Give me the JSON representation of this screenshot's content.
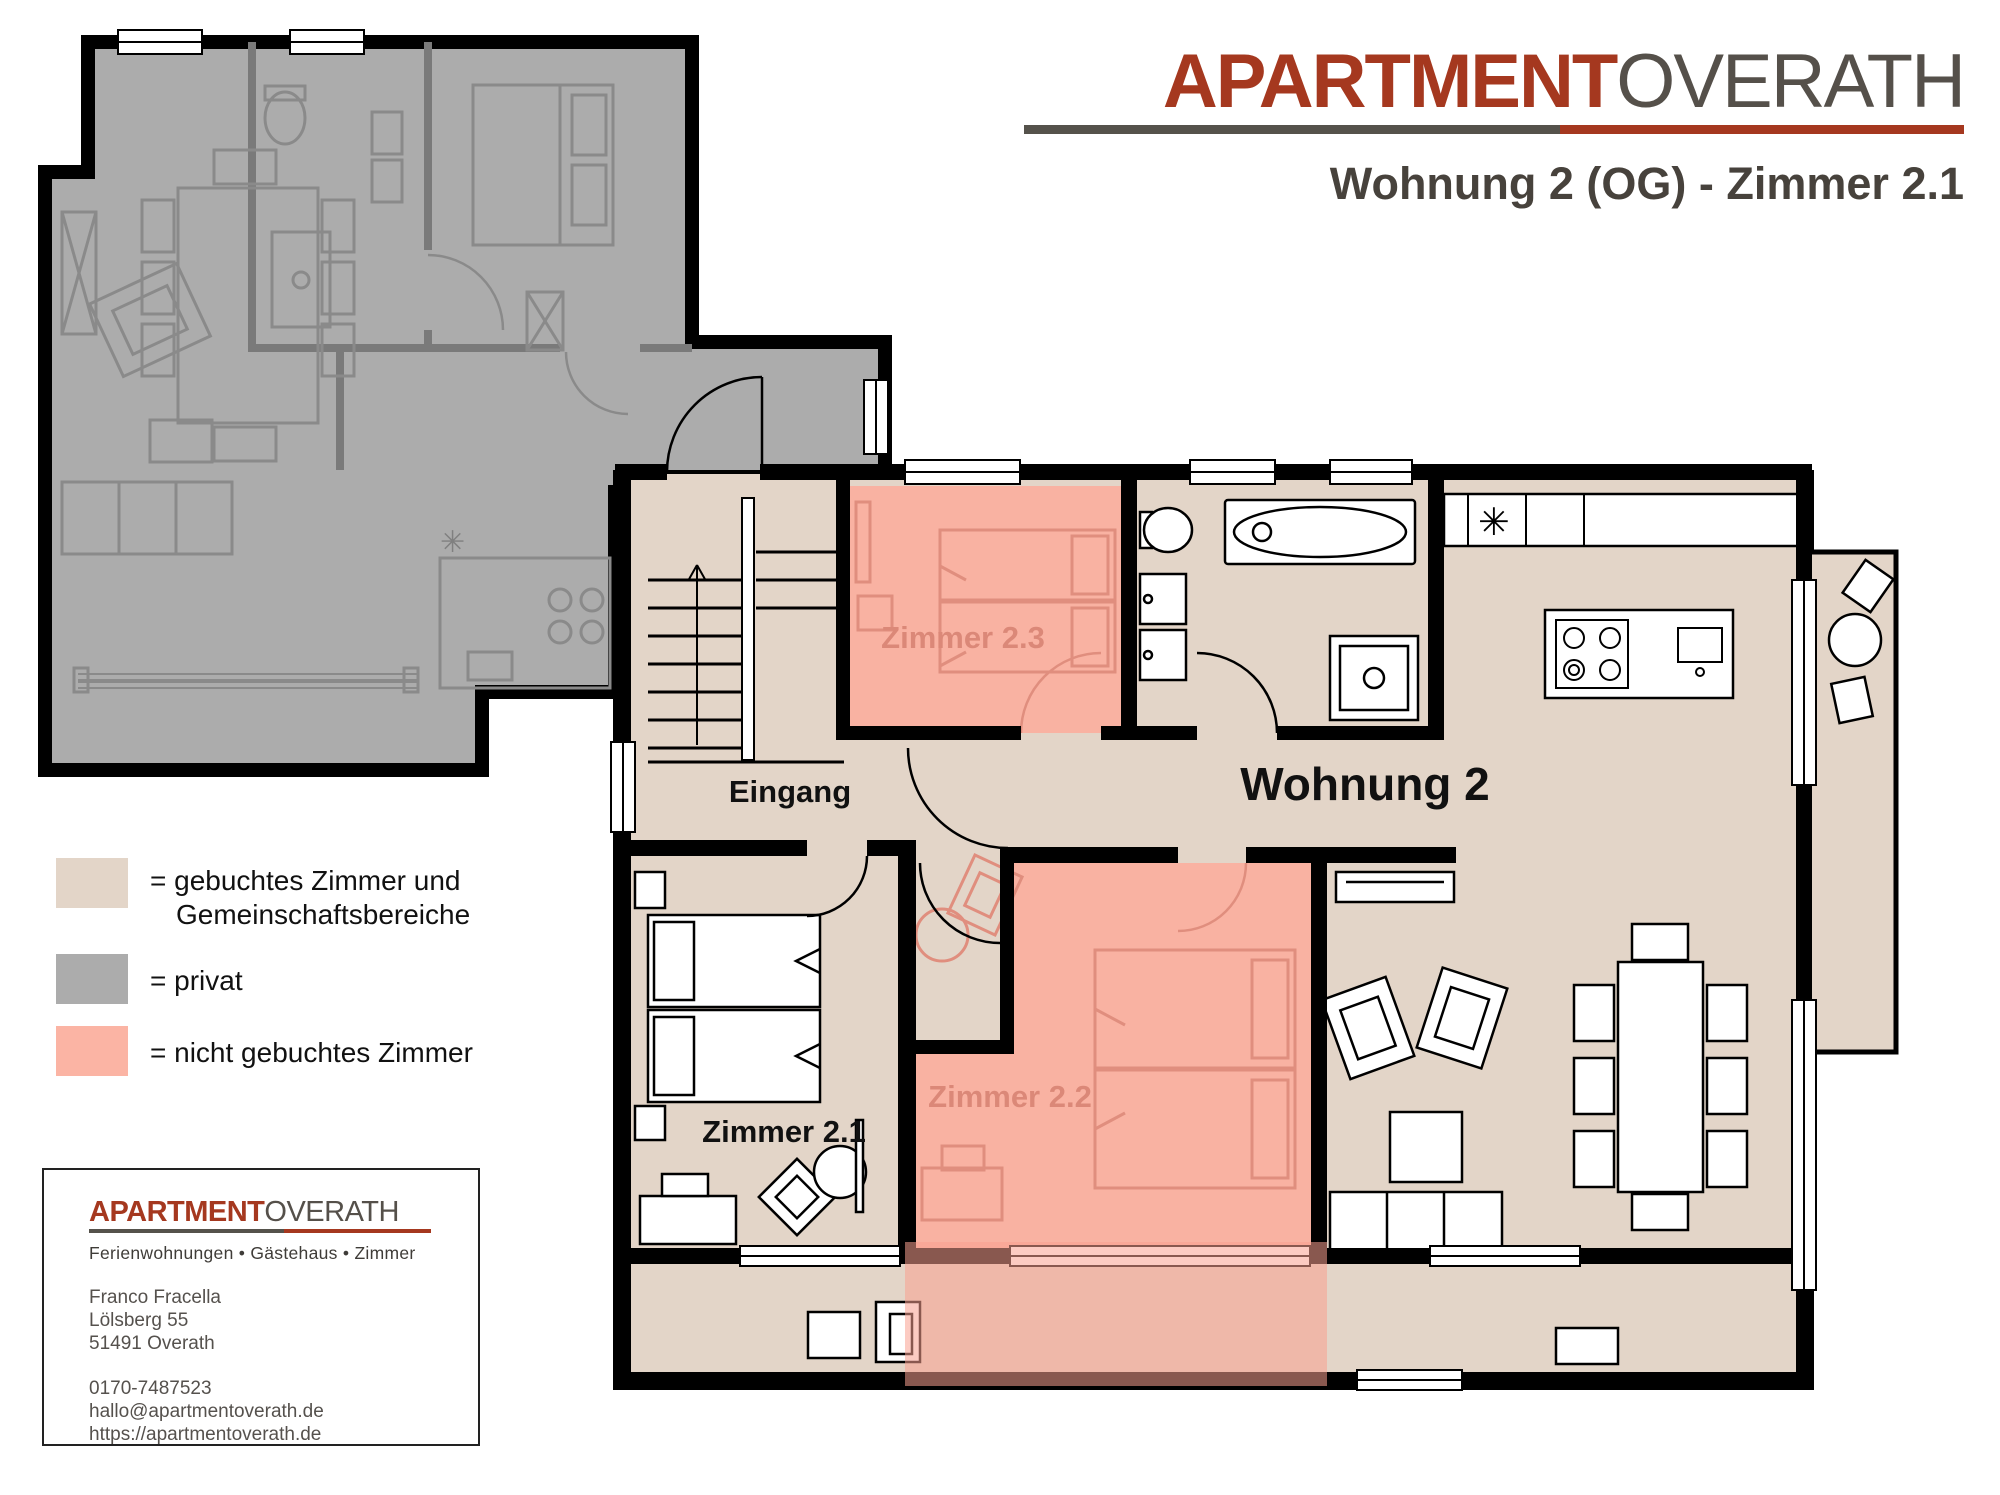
{
  "header": {
    "logo": {
      "part1": "APARTMENT",
      "part2": "OVERATH"
    },
    "subtitle": "Wohnung 2 (OG) - Zimmer 2.1"
  },
  "floorplan": {
    "labels": {
      "eingang": "Eingang",
      "wohnung_2": "Wohnung 2",
      "zimmer_2_1": "Zimmer 2.1",
      "zimmer_2_2": "Zimmer 2.2",
      "zimmer_2_3": "Zimmer 2.3"
    },
    "symbols": {
      "dishwasher_asterisk": "✳"
    },
    "colors": {
      "booked_area": "#E3D5C8",
      "private_area": "#ACACAC",
      "not_booked_room": "#F9B2A2",
      "walls": "#000000",
      "pink_furniture": "#E08E7E"
    }
  },
  "legend": {
    "items": [
      {
        "swatch_color": "#E3D5C8",
        "label": "= gebuchtes Zimmer und",
        "label_line2": "Gemeinschaftsbereiche"
      },
      {
        "swatch_color": "#ACACAC",
        "label": "= privat",
        "label_line2": ""
      },
      {
        "swatch_color": "#FBB4A4",
        "label": "= nicht gebuchtes Zimmer",
        "label_line2": ""
      }
    ]
  },
  "contact_card": {
    "logo": {
      "part1": "APARTMENT",
      "part2": "OVERATH"
    },
    "tagline": "Ferienwohnungen • Gästehaus • Zimmer",
    "contact_name": "Franco Fracella",
    "street": "Lölsberg 55",
    "city": "51491 Overath",
    "phone": "0170-7487523",
    "email": "hallo@apartmentoverath.de",
    "website": "https://apartmentoverath.de"
  }
}
